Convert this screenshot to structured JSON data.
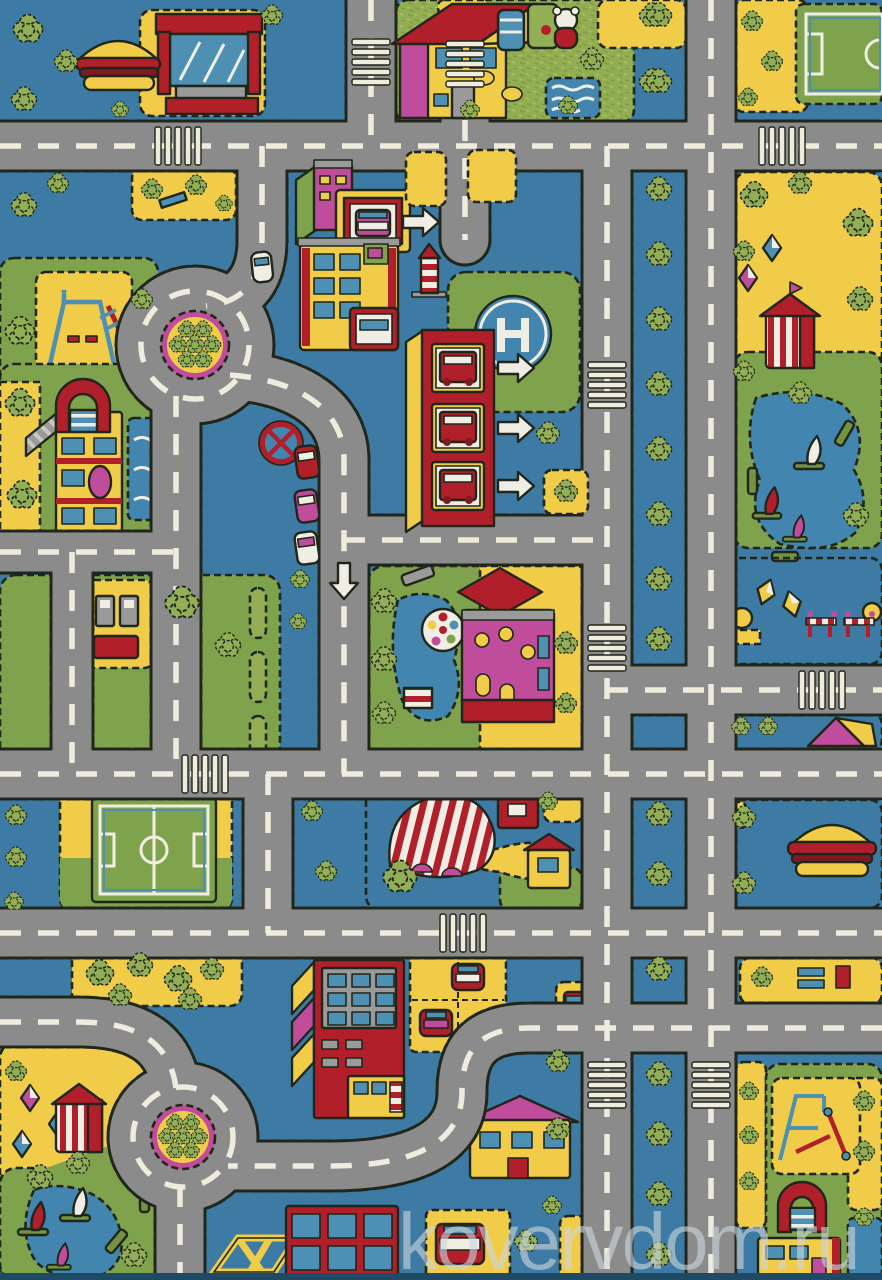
{
  "page": {
    "kind": "product-photo",
    "subject": "children's play rug with toy-town road map pattern",
    "watermark": "kovervdom.ru"
  },
  "palette": {
    "bg": "#3D7BA4",
    "road": "#8B8B8B",
    "dashw": "#EFECDE",
    "stitch": "#20261A",
    "yellow": "#F0CC49",
    "green": "#7FA24C",
    "tree": "#93AF56",
    "red": "#B01F2A",
    "darkred": "#7E1A20",
    "magenta": "#BF4D9B",
    "white": "#F0EEE4",
    "gray": "#9A9A9A",
    "lblue": "#4E8FB4",
    "wblue": "#2F6F9F",
    "olive": "#74923F",
    "pond": "#4285AE",
    "wm": "#CDD6DC"
  },
  "scene": {
    "features": [
      "hamburger-stand",
      "street-kiosk",
      "cottage-with-garden",
      "teddy-bear",
      "garden-pond",
      "football-pitch-top-right",
      "football-pitch-west",
      "roundabout-with-trees-north",
      "roundabout-with-trees-south",
      "tree-lined-boulevard",
      "fire-station-with-engines",
      "direction-arrows",
      "helipad",
      "lighthouse-tower",
      "town-shops",
      "bus-garage",
      "school-with-red-arch",
      "playground-northwest",
      "playground-southeast",
      "gas-station",
      "watermill-with-waterwheel",
      "mill-pond",
      "no-parking-sign",
      "parked-cars",
      "boating-pond-east",
      "boating-pond-southwest",
      "sailing-boats",
      "carousel-booth-east",
      "carousel-booth-southwest",
      "kites-lawn",
      "road-barriers",
      "camping-tent",
      "circus-tent",
      "winding-path",
      "apartment-block",
      "parking-lot",
      "car-kiosk",
      "climbing-frame",
      "zebra-crossings",
      "park-benches",
      "hamburger-stand-south",
      "truck"
    ],
    "median_x": 659,
    "median_trees": [
      16,
      82,
      190,
      255,
      320,
      385,
      450,
      515,
      580,
      640,
      815,
      875,
      970,
      1075,
      1135,
      1195,
      1255
    ],
    "trees": [
      [
        28,
        30,
        0.7
      ],
      [
        66,
        62,
        0.55
      ],
      [
        24,
        100,
        0.6
      ],
      [
        272,
        16,
        0.5
      ],
      [
        120,
        110,
        0.4
      ],
      [
        24,
        206,
        0.6
      ],
      [
        58,
        184,
        0.5
      ],
      [
        152,
        190,
        0.5
      ],
      [
        196,
        186,
        0.5
      ],
      [
        224,
        204,
        0.4
      ],
      [
        20,
        332,
        0.7
      ],
      [
        142,
        300,
        0.5
      ],
      [
        20,
        404,
        0.7
      ],
      [
        22,
        496,
        0.7
      ],
      [
        592,
        60,
        0.55
      ],
      [
        568,
        106,
        0.45
      ],
      [
        652,
        16,
        0.6
      ],
      [
        652,
        82,
        0.6
      ],
      [
        470,
        110,
        0.45
      ],
      [
        752,
        22,
        0.5
      ],
      [
        772,
        62,
        0.5
      ],
      [
        748,
        98,
        0.45
      ],
      [
        754,
        196,
        0.65
      ],
      [
        800,
        184,
        0.55
      ],
      [
        858,
        224,
        0.7
      ],
      [
        744,
        252,
        0.5
      ],
      [
        860,
        300,
        0.6
      ],
      [
        800,
        394,
        0.55
      ],
      [
        856,
        516,
        0.6
      ],
      [
        744,
        372,
        0.5
      ],
      [
        548,
        434,
        0.55
      ],
      [
        566,
        492,
        0.55
      ],
      [
        384,
        602,
        0.6
      ],
      [
        384,
        660,
        0.6
      ],
      [
        384,
        714,
        0.55
      ],
      [
        566,
        644,
        0.55
      ],
      [
        566,
        704,
        0.5
      ],
      [
        182,
        604,
        0.8
      ],
      [
        228,
        646,
        0.6
      ],
      [
        300,
        580,
        0.45
      ],
      [
        298,
        622,
        0.4
      ],
      [
        741,
        727,
        0.45
      ],
      [
        768,
        727,
        0.45
      ],
      [
        312,
        812,
        0.5
      ],
      [
        326,
        872,
        0.5
      ],
      [
        16,
        816,
        0.5
      ],
      [
        16,
        858,
        0.5
      ],
      [
        14,
        902,
        0.45
      ],
      [
        400,
        878,
        0.8
      ],
      [
        548,
        802,
        0.45
      ],
      [
        744,
        818,
        0.55
      ],
      [
        744,
        884,
        0.55
      ],
      [
        100,
        974,
        0.65
      ],
      [
        140,
        966,
        0.6
      ],
      [
        178,
        980,
        0.65
      ],
      [
        212,
        970,
        0.55
      ],
      [
        120,
        996,
        0.55
      ],
      [
        190,
        1000,
        0.55
      ],
      [
        762,
        978,
        0.5
      ],
      [
        40,
        1178,
        0.6
      ],
      [
        78,
        1164,
        0.55
      ],
      [
        134,
        1256,
        0.6
      ],
      [
        16,
        1072,
        0.5
      ],
      [
        526,
        1242,
        0.55
      ],
      [
        552,
        1206,
        0.45
      ],
      [
        558,
        1062,
        0.55
      ],
      [
        558,
        1130,
        0.55
      ],
      [
        749,
        1092,
        0.45
      ],
      [
        749,
        1136,
        0.45
      ],
      [
        749,
        1182,
        0.45
      ],
      [
        864,
        1102,
        0.5
      ],
      [
        864,
        1152,
        0.5
      ],
      [
        864,
        1218,
        0.45
      ],
      [
        212,
        345,
        0.42
      ],
      [
        203,
        360,
        0.42
      ],
      [
        187,
        360,
        0.42
      ],
      [
        178,
        345,
        0.42
      ],
      [
        187,
        330,
        0.42
      ],
      [
        203,
        330,
        0.42
      ],
      [
        195,
        345,
        0.45
      ],
      [
        199,
        1137,
        0.4
      ],
      [
        191,
        1151,
        0.4
      ],
      [
        175,
        1151,
        0.4
      ],
      [
        167,
        1137,
        0.4
      ],
      [
        175,
        1123,
        0.4
      ],
      [
        191,
        1123,
        0.4
      ],
      [
        183,
        1137,
        0.42
      ]
    ],
    "zebra_crossings": [
      [
        371,
        62,
        "v"
      ],
      [
        465,
        64,
        "v"
      ],
      [
        178,
        146,
        "h"
      ],
      [
        782,
        146,
        "h"
      ],
      [
        607,
        385,
        "v"
      ],
      [
        607,
        648,
        "v"
      ],
      [
        822,
        690,
        "h"
      ],
      [
        205,
        774,
        "h"
      ],
      [
        463,
        933,
        "h"
      ],
      [
        607,
        1085,
        "v"
      ],
      [
        711,
        1085,
        "v"
      ]
    ],
    "arrows_right": [
      [
        420,
        222
      ],
      [
        515,
        368
      ],
      [
        515,
        428
      ],
      [
        515,
        486
      ]
    ],
    "arrows_down": [
      [
        344,
        580
      ]
    ]
  }
}
